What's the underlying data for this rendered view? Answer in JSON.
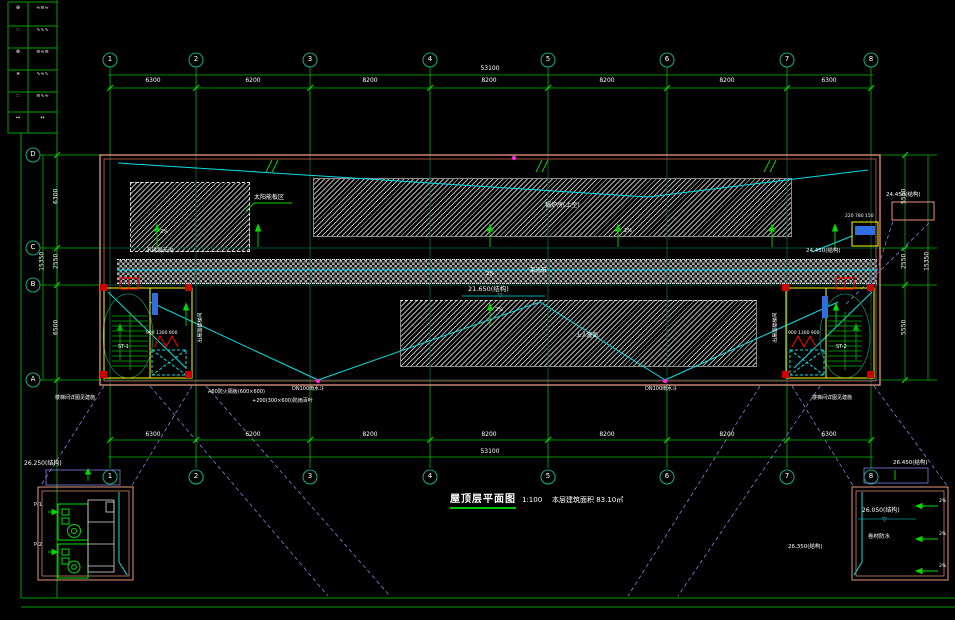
{
  "sheet": {
    "title": "屋顶层平面图",
    "scale": "1:100",
    "area_note": "本层建筑面积 83.10㎡"
  },
  "colors": {
    "background": "#000000",
    "grid_green": "#00c000",
    "annotation_green": "#00dc00",
    "cyan": "#00e0e6",
    "wall_pink": "#e8977d",
    "highlight_yellow": "#ffff00",
    "alert_red": "#e00000",
    "projection_violet": "#8080e0",
    "drain_magenta": "#ff2ad4"
  },
  "grid": {
    "cols": [
      "1",
      "2",
      "3",
      "4",
      "5",
      "6",
      "7",
      "8"
    ],
    "rows": [
      "D",
      "C",
      "B",
      "A"
    ],
    "top_dims": [
      "6300",
      "6200",
      "8200",
      "8200",
      "8200",
      "8200",
      "6300"
    ],
    "top_total": "53100",
    "bottom_dims": [
      "6300",
      "6200",
      "8200",
      "8200",
      "8200",
      "8200",
      "6300"
    ],
    "bottom_total": "53100",
    "left_dims": [
      "6300",
      "2550",
      "6500"
    ],
    "left_total": "15350",
    "right_dims": [
      "5550",
      "2550",
      "5550"
    ],
    "right_total": "15350"
  },
  "labels": {
    "gutter": "不锈钢天沟",
    "solar_area": "太阳能板区",
    "boiler_room": "锅炉房(上空)",
    "roof_walk": "上人屋面",
    "skylight_band": "采光带",
    "slope": "2%",
    "level_band": "21.650(结构)",
    "level_tr": "24.450(结构)",
    "box_nums": "220 780 150",
    "stair_dims": "900 1300 900",
    "stair1": "ST-1",
    "stair2": "ST-2",
    "stair_note": "出屋面楼梯间",
    "note_stair_detail": "楼梯间详图见建施",
    "note_louver": "A60防火隔板(600×600)",
    "note_vent": "+200(300×600)防雨百叶",
    "note_drain": "DN100雨水斗",
    "tri": "▽"
  },
  "details": {
    "left": {
      "level_top": "26.250(结构)",
      "fan1": "P-1",
      "fan2": "P-2"
    },
    "right": {
      "level_top": "26.450(结构)",
      "level_mid": "26.050(结构)",
      "level_left": "26.350(结构)",
      "note": "卷材防水",
      "slope": "2%"
    }
  },
  "sidebar": {
    "rows": [
      {
        "a": "⊕",
        "b": "≈≋≈"
      },
      {
        "a": "∷",
        "b": "∿∿∿"
      },
      {
        "a": "⊗",
        "b": "≋≈≋"
      },
      {
        "a": "∗",
        "b": "∿≈∿"
      },
      {
        "a": "∷",
        "b": "≋∿≈"
      },
      {
        "a": "↔",
        "b": "↔"
      }
    ]
  }
}
